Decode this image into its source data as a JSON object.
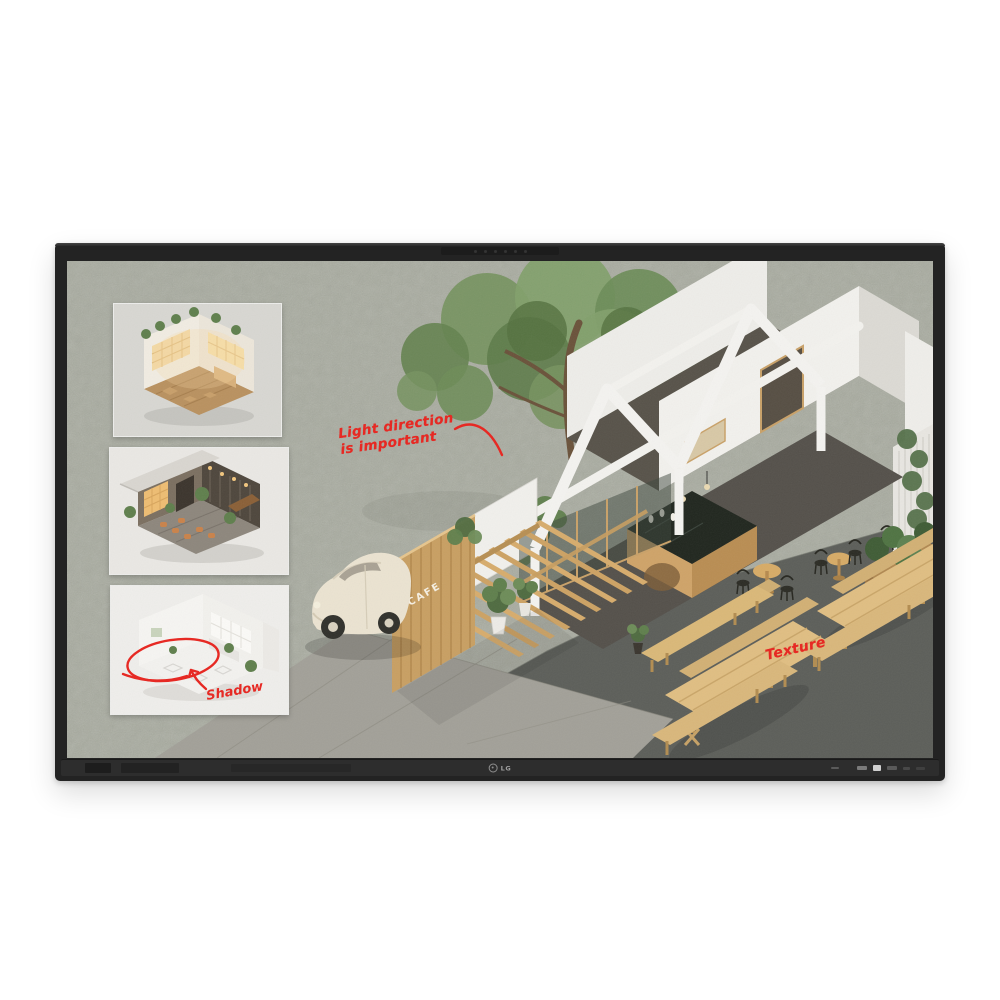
{
  "device": {
    "brand_logo": "LG",
    "bezel_color": "#232323",
    "tray_color": "#2d2d2d"
  },
  "screen": {
    "background_color": "#a8ab9f",
    "ink_color": "#e8241e",
    "cafe_sign": "CAFE",
    "annotations": {
      "light_direction_line1": "Light direction",
      "light_direction_line2": "is important",
      "texture": "Texture",
      "shadow": "Shadow"
    },
    "thumbnails": [
      {
        "name": "warm-lit-cafe-interior-render"
      },
      {
        "name": "dark-moody-cafe-interior-render"
      },
      {
        "name": "bright-white-cafe-interior-render"
      }
    ]
  }
}
